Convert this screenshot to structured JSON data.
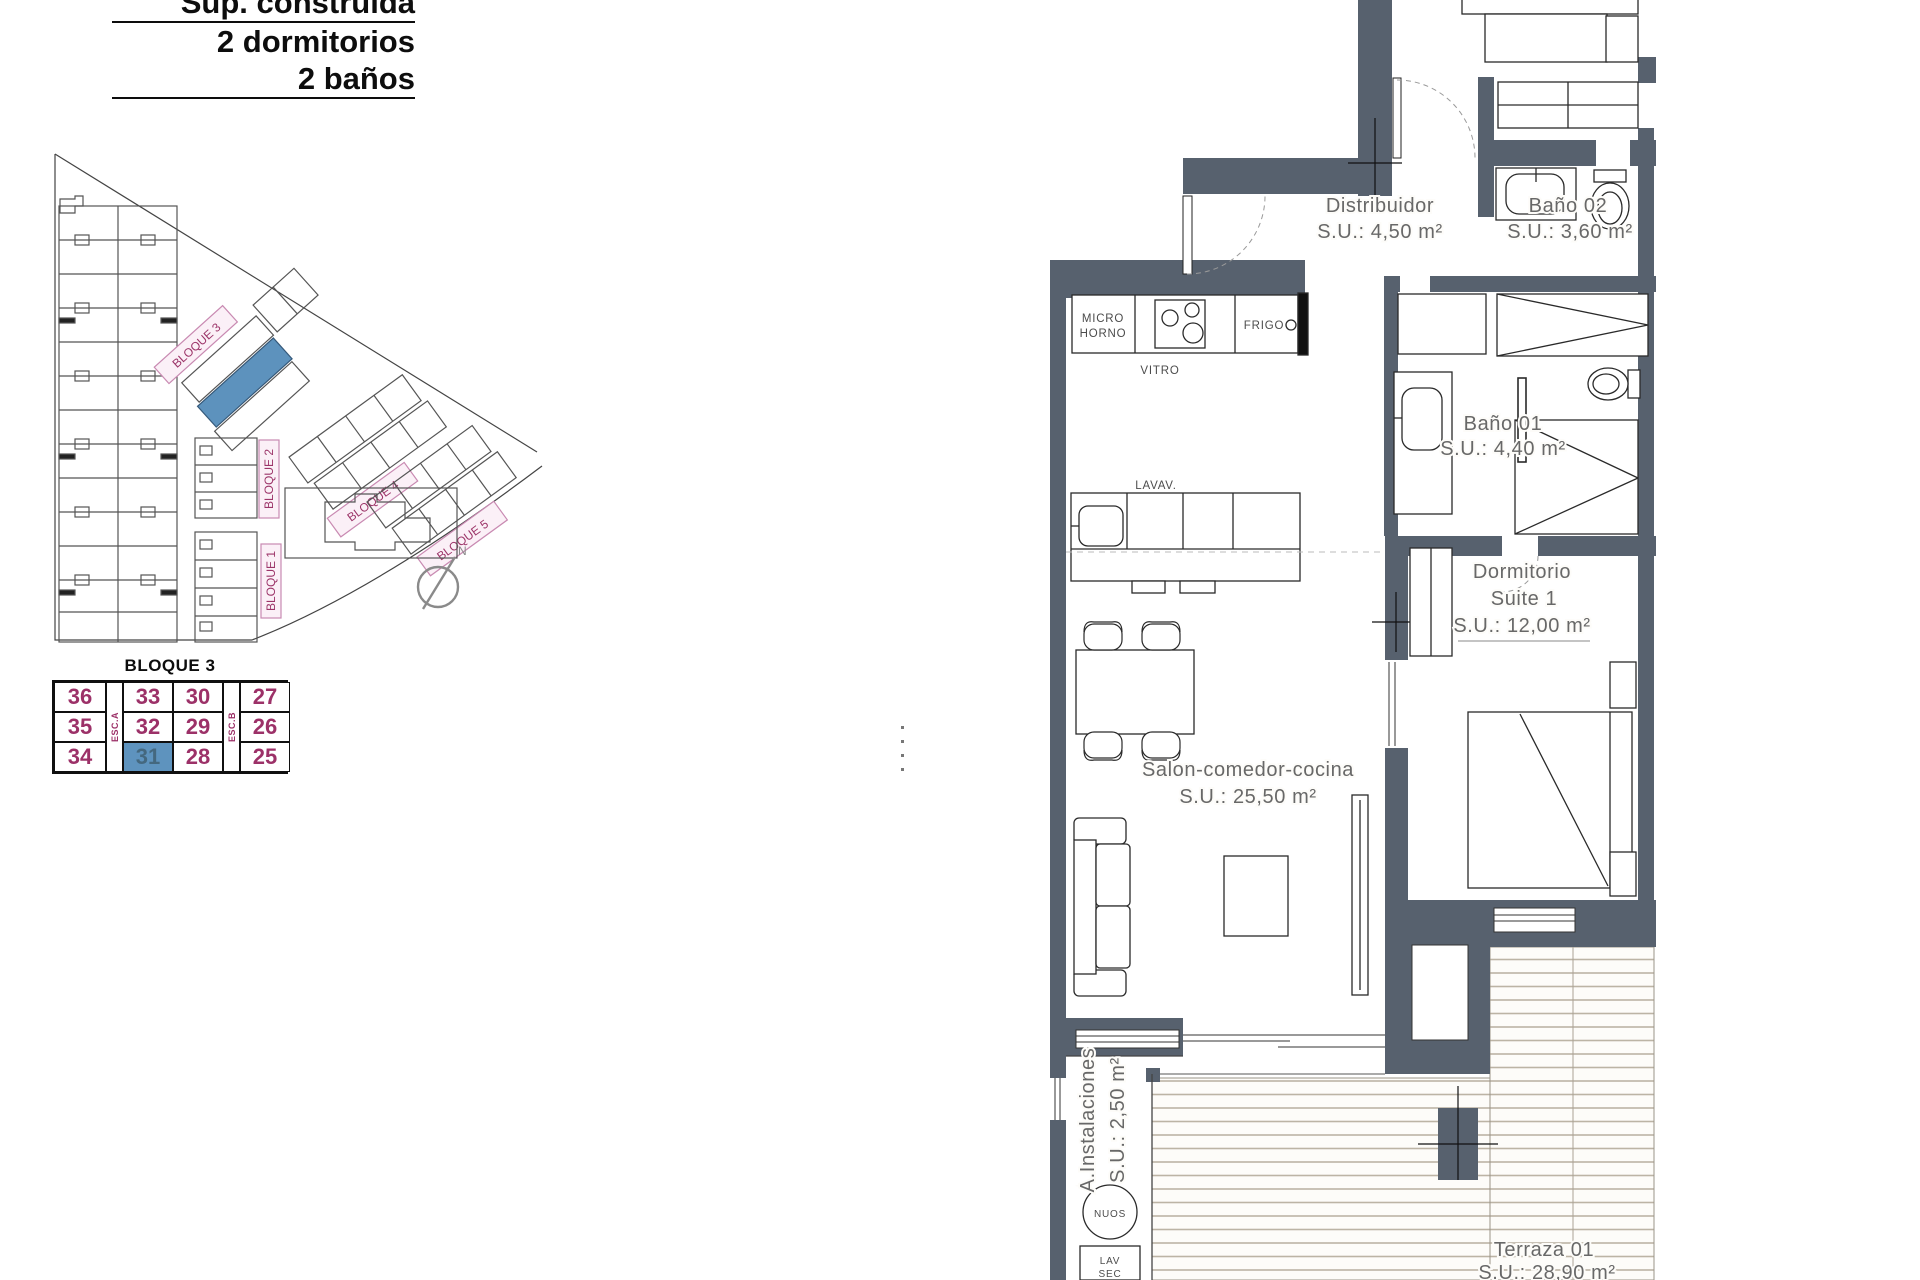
{
  "header": {
    "line1": "Sup. construida",
    "line2": "2 dormitorios",
    "line3": "2 baños"
  },
  "site_plan": {
    "block_labels": {
      "b1": "BLOQUE 1",
      "b2": "BLOQUE 2",
      "b3": "BLOQUE 3",
      "b4": "BLOQUE 4",
      "b5": "BLOQUE 5"
    },
    "compass_label": "N"
  },
  "unit_table": {
    "title": "BLOQUE 3",
    "esc_a": "ESC.A",
    "esc_b": "ESC.B",
    "rows": [
      [
        "36",
        "33",
        "30",
        "27"
      ],
      [
        "35",
        "32",
        "29",
        "26"
      ],
      [
        "34",
        "31",
        "28",
        "25"
      ]
    ],
    "selected_unit": "31"
  },
  "floor_plan": {
    "distribuidor": {
      "name": "Distribuidor",
      "area": "S.U.: 4,50 m²"
    },
    "bano02": {
      "name": "Baño 02",
      "area": "S.U.: 3,60 m²"
    },
    "bano01": {
      "name": "Baño 01",
      "area": "S.U.: 4,40 m²"
    },
    "suite": {
      "l1": "Dormitorio",
      "l2": "Suite 1",
      "l3": "S.U.: 12,00 m²"
    },
    "salon": {
      "l1": "Salon-comedor-cocina",
      "l2": "S.U.: 25,50 m²"
    },
    "instalaciones": {
      "l1": "A.Instalaciones",
      "l2": "S.U.: 2,50 m²"
    },
    "terraza": {
      "l1": "Terraza 01",
      "l2": "S.U.: 28,90 m²"
    },
    "kitchen": {
      "micro1": "MICRO",
      "micro2": "HORNO",
      "vitro": "VITRO",
      "frigo": "FRIGO",
      "lavav": "LAVAV."
    },
    "nuos": "NUOS",
    "lav1": "LAV",
    "lav2": "SEC"
  },
  "colors": {
    "wall": "#57616e",
    "unit_number": "#9c3168",
    "selected_bg": "#5e93be",
    "selected_text": "#44687f",
    "block_label_pink_bg": "#fbf0f7",
    "block_label_pink_border": "#c98ab2",
    "highlight_building": "#5d92bd",
    "deck_line": "#bcb4a5"
  }
}
